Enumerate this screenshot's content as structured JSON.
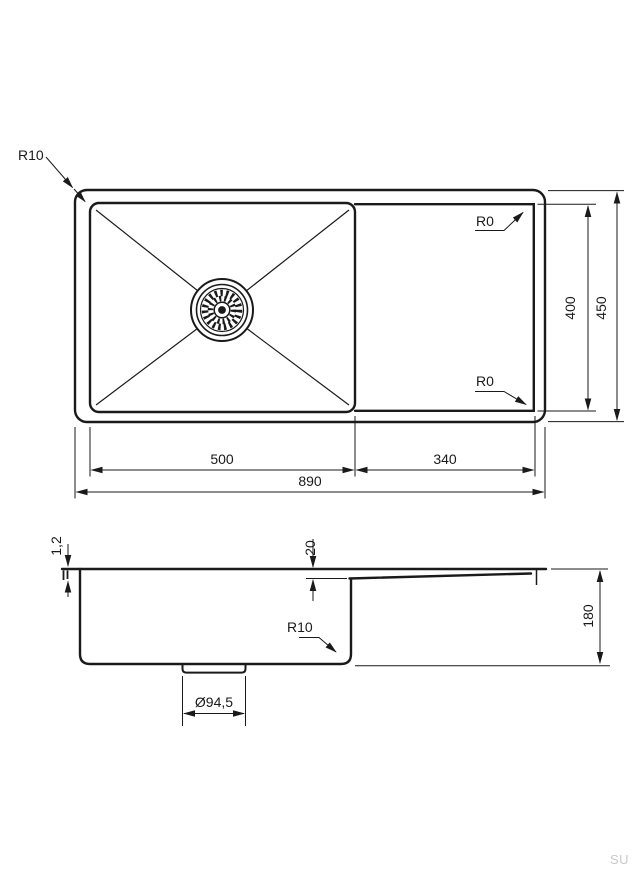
{
  "top_view": {
    "labels": {
      "corner_radius": "R10",
      "corner_top_right": "R0",
      "corner_bottom_right": "R0"
    },
    "dimensions": {
      "bowl_width": "500",
      "drainboard_width": "340",
      "overall_width": "890",
      "bowl_depth": "400",
      "overall_depth": "450"
    }
  },
  "side_view": {
    "labels": {
      "corner_radius": "R10"
    },
    "dimensions": {
      "sheet_thickness": "1,2",
      "step_depth": "20",
      "overall_height": "180",
      "drain_diameter": "Ø94,5"
    }
  },
  "watermark": "SU",
  "colors": {
    "line": "#1a1a1a",
    "watermark": "#c9c9c9",
    "background": "#ffffff"
  }
}
